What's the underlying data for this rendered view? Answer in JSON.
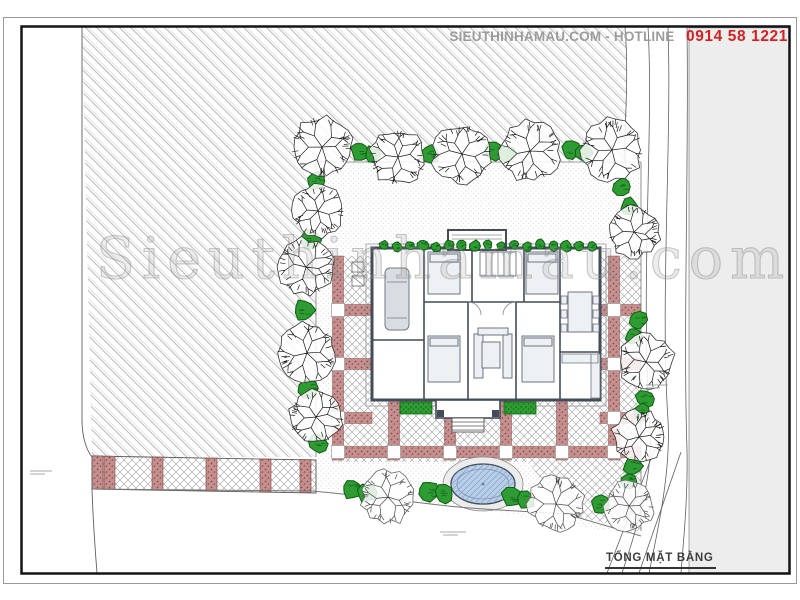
{
  "header": {
    "brand_hotline_text": "SIEUTHINHAMAU.COM - HOTLINE",
    "phone_number": "0914 58 1221"
  },
  "watermark": {
    "text": "Sieuthinhamau.com"
  },
  "title_block": {
    "drawing_title": "TỔNG MẶT BẰNG"
  },
  "colors": {
    "accent_red": "#d42222",
    "vegetation_green": "#2f9b33",
    "pool_blue": "#b9cfe8",
    "paving_red": "#c59190",
    "hatch_gray": "#b8b8b8",
    "panel_gray": "#ededed",
    "wall_dark": "#434c58"
  }
}
